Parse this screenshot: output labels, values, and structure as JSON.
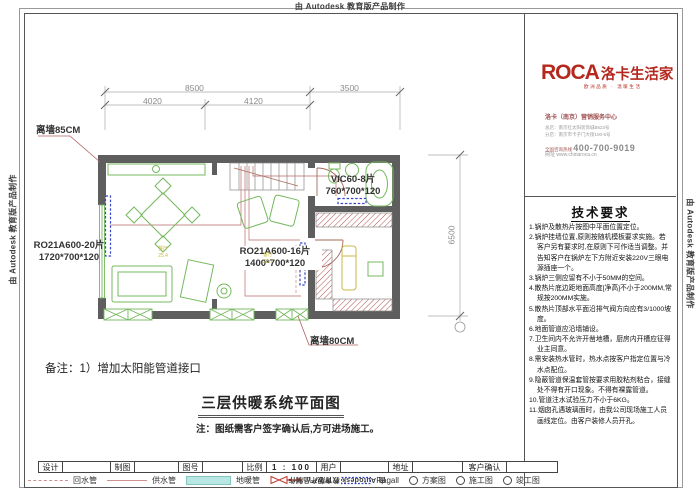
{
  "watermark": "由 Autodesk 教育版产品制作",
  "logo": {
    "brand_en": "ROCA",
    "brand_cn": "洛卡生活家",
    "tagline": "欧洲品质 · 温暖生活",
    "center": "洛卡（南京）营销服务中心",
    "addr1": "总店：南京红太阳装饰城B623号",
    "addr2": "分店：南京市卡子门大街100-5号",
    "phone_label": "全国咨询热线 ",
    "phone": "400-700-9019",
    "website": "网址 www.chinaroca.cn"
  },
  "tech": {
    "title": "技术要求",
    "items": [
      "1.锅炉及散热片按图中平面位置定位。",
      "2.锅炉挂墙位置,原则按随机模板要求实施。若客户另有要求时,在原则下可作适当调整。并告知客户在锅炉左下方附近安装220V三眼电源插座一个。",
      "3.锅炉三侧应留有不小于50MM的空间。",
      "4.散热片底边距地面高度[净高]不小于200MM,常规按200MM实施。",
      "5.散热片顶部水平面沿排气阀方向应有3/1000坡度。",
      "6.地面管道应沿墙铺设。",
      "7.卫生间内不允许开凿地槽，厨房内开槽应征得业主同意。",
      "8.需安装热水管时，热水点按客户指定位置与冷水点配位。",
      "9.隐蔽管道保温套管按要求用胶粘剂粘合，接缝处不得有开口现象。不得有裸露管道。",
      "10.管道注水试验压力不小于6KG。",
      "11.烟囱孔遇玻璃面时，由我公司现场施工人员画线定位。由客户装修人员开孔。"
    ]
  },
  "plan": {
    "dim_8500": "8500",
    "dim_4020": "4020",
    "dim_4120": "4120",
    "dim_3500": "3500",
    "dim_6500": "6500",
    "label_wall85": "离墙85CM",
    "label_rad20_l1": "RO21A600-20片",
    "label_rad20_l2": "1720*700*120",
    "label_vic_l1": "VIC60-8片",
    "label_vic_l2": "760*700*120",
    "label_rad16_l1": "RO21A600-16片",
    "label_rad16_l2": "1400*700*120",
    "label_wall80": "离墙80CM",
    "room_dining": "餐厅",
    "room_dining_area": "25.4",
    "room_living": "客厅",
    "room_living_area": "23.7",
    "remark": "备注：1）增加太阳能管道接口",
    "drawing_title": "三层供暖系统平面图",
    "note": "注：图纸需客户签字确认后,方可进场施工。"
  },
  "titleblock": {
    "design": "设计",
    "draft": "制图",
    "drawing_no": "图号",
    "scale": "比例",
    "scale_value": "1 : 100",
    "user": "用户",
    "address": "地址",
    "customer_confirm": "客户确认"
  },
  "legend": {
    "return_pipe": "回水管",
    "supply_pipe": "供水管",
    "floor_pipe": "地暖管",
    "unical": "Unical",
    "ragall": "Ragall",
    "scheme": "方案图",
    "construction": "施工图",
    "completion": "竣工图"
  }
}
